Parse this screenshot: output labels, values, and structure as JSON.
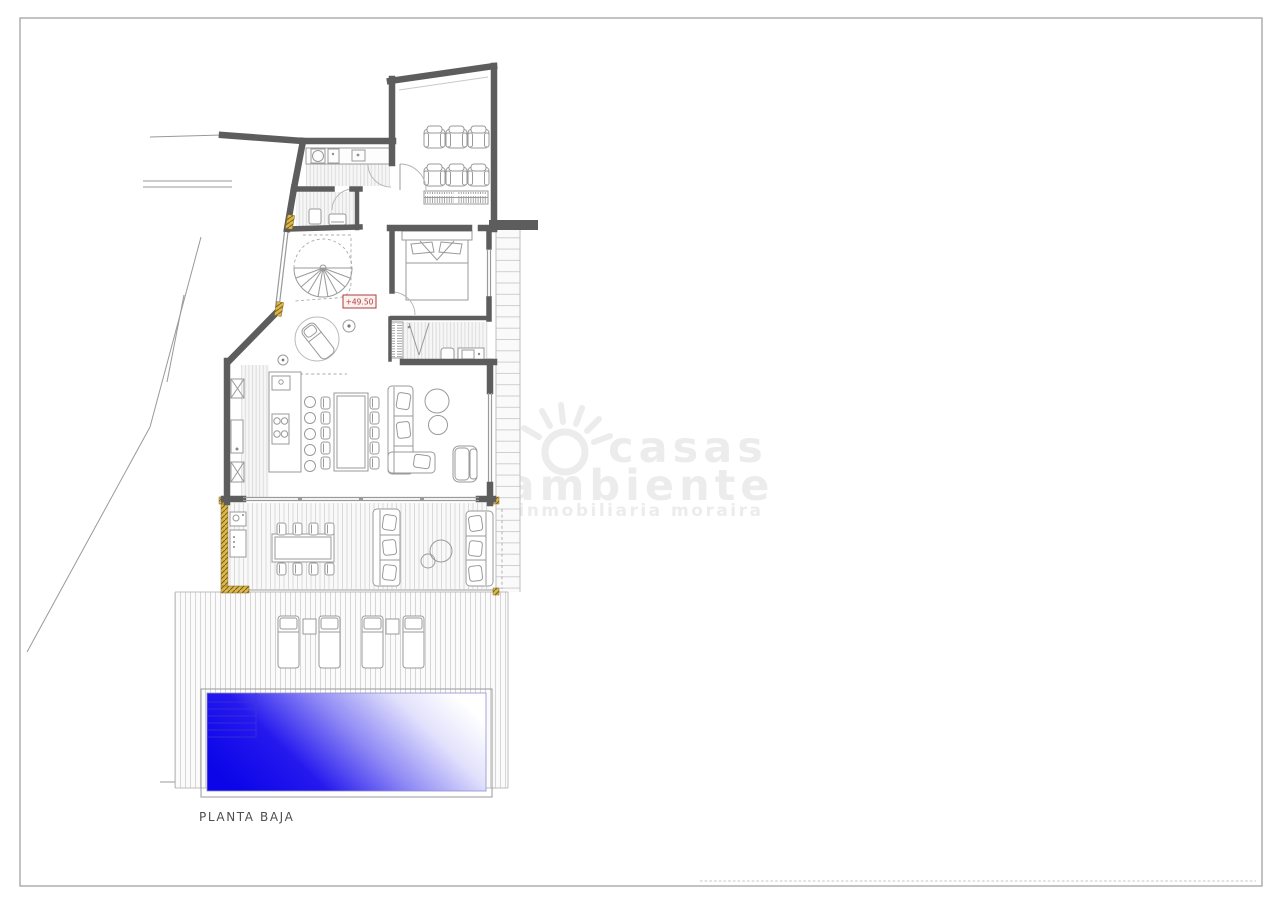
{
  "page": {
    "title": "PLANTA BAJA",
    "plan_level_label": "+49.50"
  },
  "watermark": {
    "brand_line1": "casas",
    "brand_line2": "ambiente",
    "tagline": "inmobiliaria   moraira",
    "logo": "sun-icon"
  },
  "colors": {
    "wall": "#5d5d5d",
    "wall-light": "#9a9a9a",
    "furniture": "#9a9a9a",
    "floor-stripe": "#dddddd",
    "floor-fill": "#f6f6f6",
    "accent-gold": "#d9b84f",
    "accent-gold-dark": "#7a5c17",
    "label-red": "#b23b3b",
    "label-red-fill": "#faf1f1",
    "pool-deep": "#0b05e8",
    "pool-mid": "#8f8af5",
    "pool-light": "#ffffff",
    "frame": "#adadad",
    "site-line": "#999999",
    "watermark-gray": "#ececec",
    "title-gray": "#4f4f4f"
  }
}
